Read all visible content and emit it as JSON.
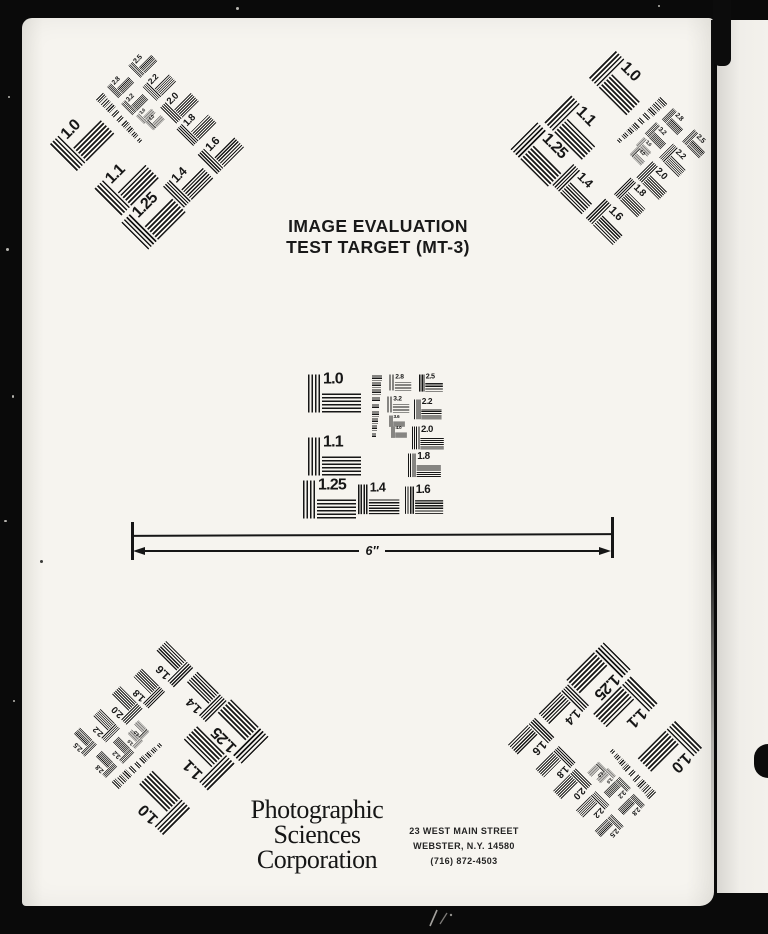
{
  "colors": {
    "ink": "#161616",
    "paper": "#f6f4ef",
    "backdrop": "#0a0a0a",
    "paper2": "#eceae5"
  },
  "header": {
    "title_line1": "IMAGE EVALUATION",
    "title_line2": "TEST TARGET (MT-3)"
  },
  "scale_bar": {
    "label": "6″"
  },
  "footer": {
    "company_lines": {
      "0": "Photographic",
      "1": "Sciences",
      "2": "Corporation"
    },
    "address_lines": {
      "0": "23 WEST MAIN STREET",
      "1": "WEBSTER, N.Y. 14580",
      "2": "(716) 872-4503"
    }
  },
  "pattern": {
    "elements": [
      {
        "label": "1.0",
        "x": 13,
        "y": 9,
        "s": 1
      },
      {
        "label": "1.1",
        "x": 13,
        "y": 72,
        "s": 1
      },
      {
        "label": "1.25",
        "x": 8,
        "y": 115,
        "s": 1
      },
      {
        "label": "1.4",
        "x": 63,
        "y": 119,
        "s": 0.78
      },
      {
        "label": "1.6",
        "x": 110,
        "y": 121,
        "s": 0.72
      },
      {
        "label": "1.8",
        "x": 113,
        "y": 88,
        "s": 0.62
      },
      {
        "label": "2.0",
        "x": 117,
        "y": 61,
        "s": 0.6
      },
      {
        "label": "2.2",
        "x": 119,
        "y": 34,
        "s": 0.52
      },
      {
        "label": "2.5",
        "x": 124,
        "y": 9,
        "s": 0.45
      },
      {
        "label": "2.8",
        "x": 94,
        "y": 9,
        "s": 0.42
      },
      {
        "label": "3.2",
        "x": 92,
        "y": 31,
        "s": 0.42
      },
      {
        "label": "3.6",
        "x": 94,
        "y": 50,
        "s": 0.3
      },
      {
        "label": "4.0",
        "x": 96,
        "y": 61,
        "s": 0.3
      }
    ],
    "micro": {
      "x": 77,
      "y": 10,
      "rows": 9
    },
    "instances": [
      {
        "id": "top-left",
        "cx": 145,
        "cy": 146,
        "rot": -45
      },
      {
        "id": "top-right",
        "cx": 614,
        "cy": 146,
        "rot": 45
      },
      {
        "id": "center",
        "cx": 374,
        "cy": 443,
        "rot": 0
      },
      {
        "id": "bottom-left",
        "cx": 165,
        "cy": 740,
        "rot": 225
      },
      {
        "id": "bottom-right",
        "cx": 607,
        "cy": 746,
        "rot": 135
      }
    ]
  }
}
